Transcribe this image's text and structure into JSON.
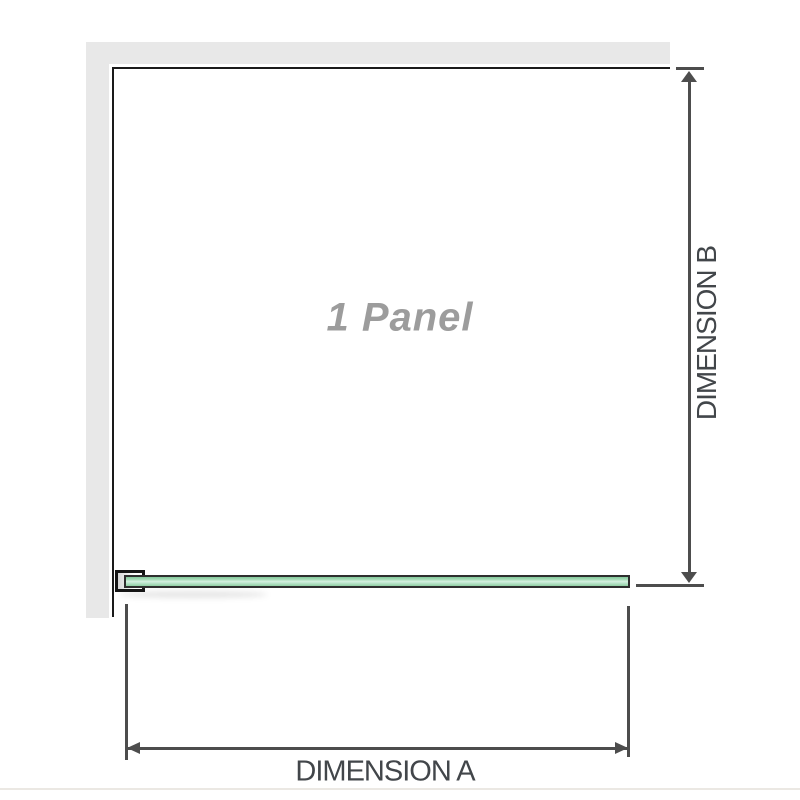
{
  "diagram": {
    "title": "shower panel dimension diagram",
    "panel_label": "1 Panel",
    "panel_count": 1,
    "dimension_a_label": "DIMENSION A",
    "dimension_b_label": "DIMENSION B",
    "icons": {
      "arrow_up": "dimension-b upper arrowhead",
      "arrow_down": "dimension-b lower arrowhead",
      "arrow_left": "dimension-a left arrowhead",
      "arrow_right": "dimension-a right arrowhead"
    },
    "colors": {
      "wall": "#e8e8e8",
      "panel_outline": "#1a1a1a",
      "dimension_line": "#4d4d4d",
      "dimension_text": "#42464a",
      "panel_label_text": "#9c9c9c",
      "glass_fill": "#a9dcba",
      "glass_highlight": "#d5f0e0",
      "glass_outline": "#2e2e2e",
      "bracket_outline": "#151515",
      "background": "#ffffff"
    }
  }
}
